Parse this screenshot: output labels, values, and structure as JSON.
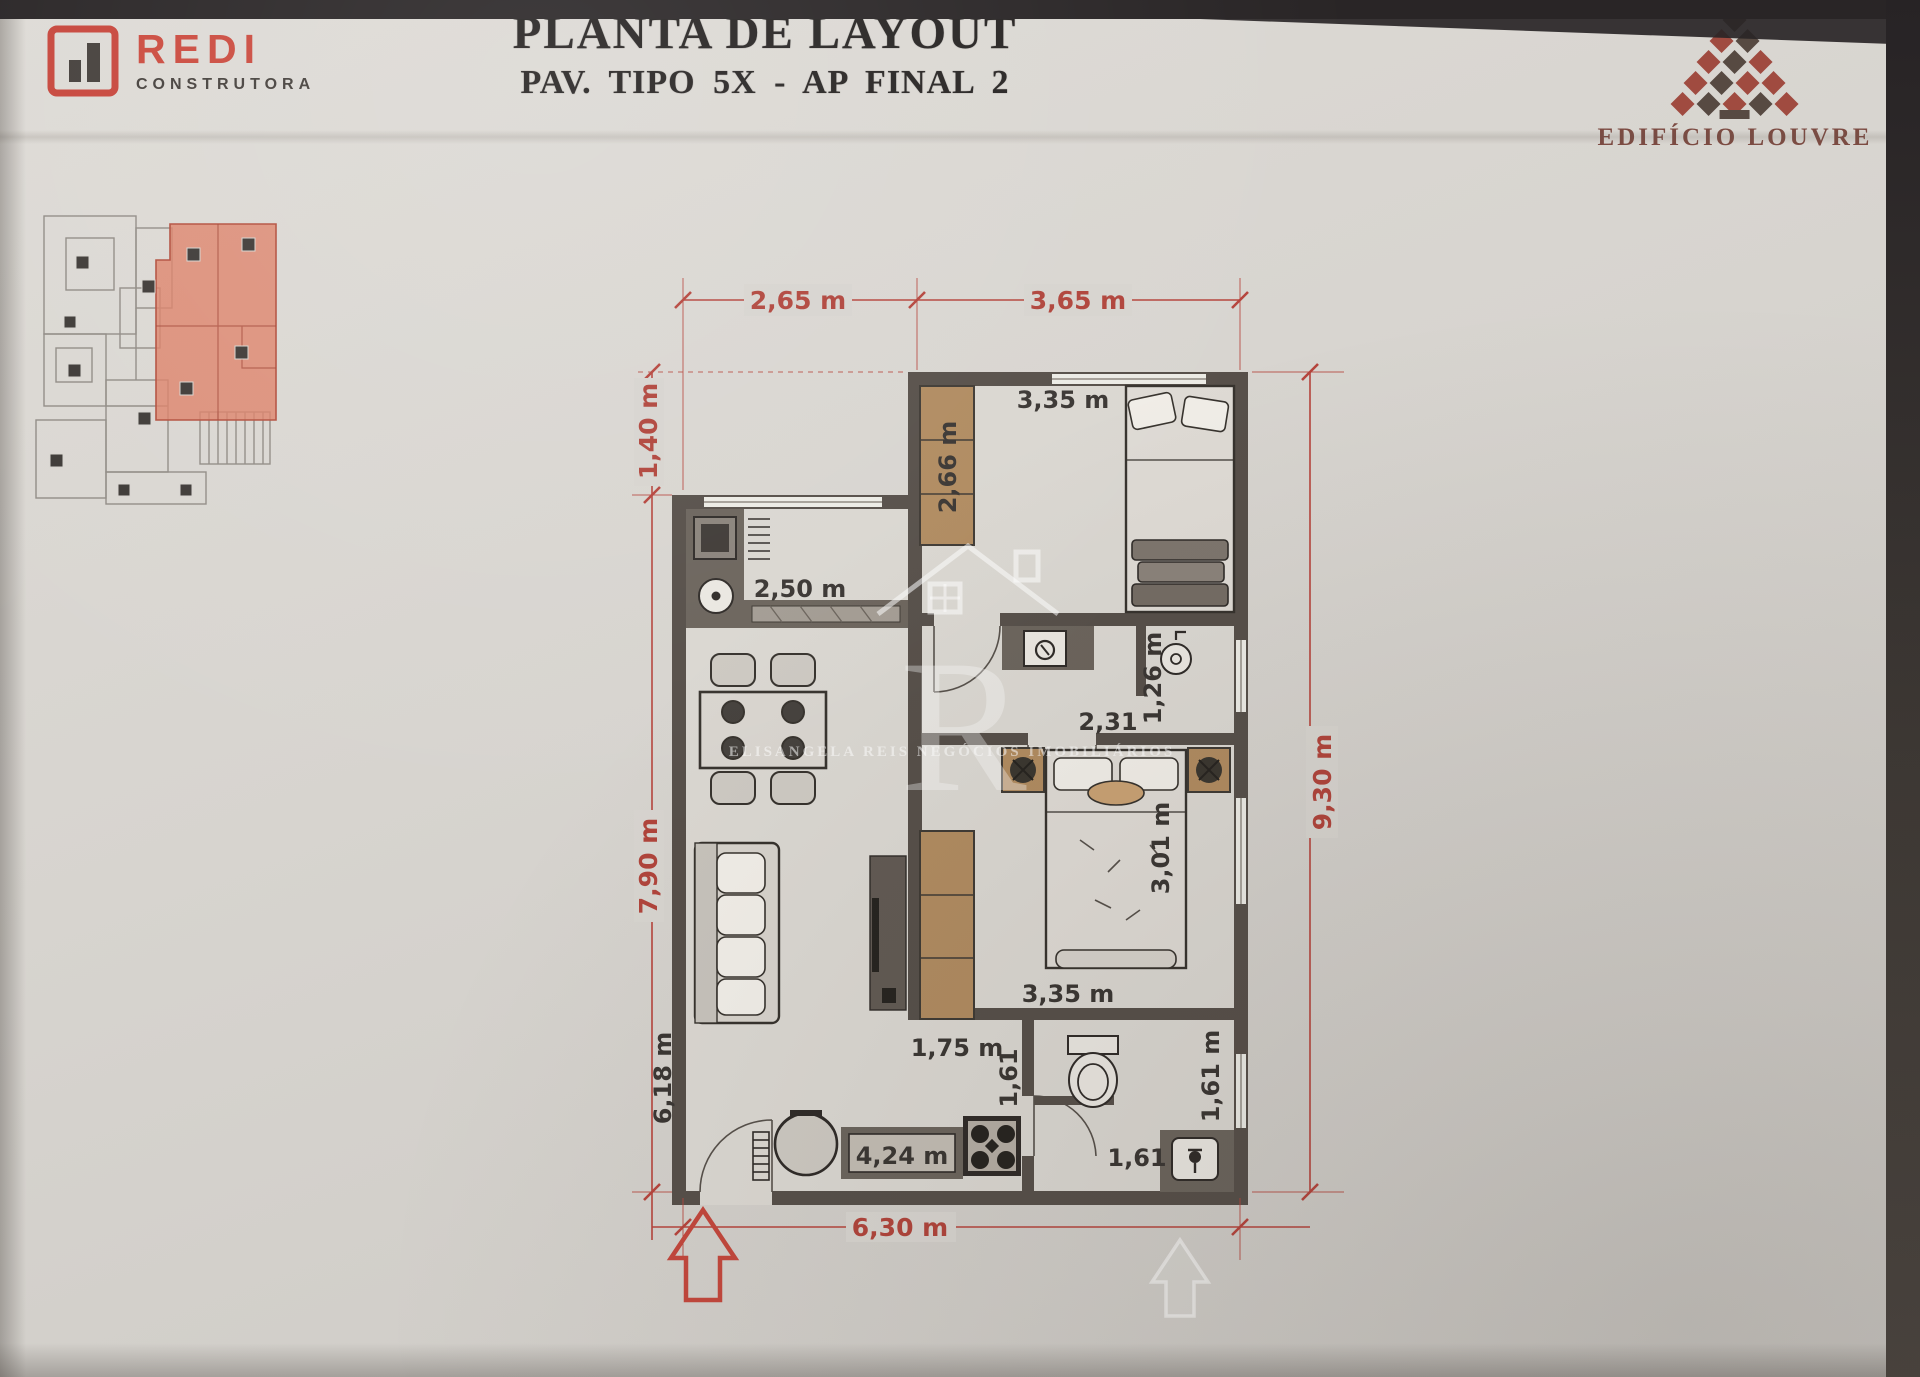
{
  "header": {
    "title": "PLANTA DE LAYOUT",
    "subtitle": "PAV. TIPO 5X - AP FINAL 2"
  },
  "brand_left": {
    "name": "REDI",
    "tagline": "CONSTRUTORA"
  },
  "brand_right": {
    "name": "EDIFÍCIO LOUVRE"
  },
  "watermark": {
    "monogram": "R",
    "caption": "ELISANGELA REIS NEGÓCIOS IMOBILIÁRIOS"
  },
  "dims": {
    "exterior": {
      "top_left": "2,65 m",
      "top_right": "3,65 m",
      "left_offset": "1,40 m",
      "left_main": "7,90 m",
      "right_total": "9,30 m",
      "bottom_total": "6,30 m"
    },
    "interior": {
      "bedroom1_width": "3,35 m",
      "wardrobe1": "2,66 m",
      "kitchen_width": "2,50 m",
      "hall_width": "2,31",
      "laundry_width": "1,26 m",
      "bedroom2_length": "3,01 m",
      "bedroom2_width": "3,35 m",
      "passage_width": "1,75 m",
      "passage_side": "1,61",
      "living_length": "6,18 m",
      "counter_length": "4,24 m",
      "bathroom_width": "1,61",
      "bathroom_length": "1,61 m"
    }
  },
  "icons": {
    "redi_mark": "bar-chart-in-red-square",
    "louvre_pyramid": "diamond-lattice-pyramid",
    "entrance_arrow": "outlined-up-arrow",
    "washing_machine": "front-load-washer",
    "laundry_tub": "round-tub",
    "plant": "potted-plant"
  },
  "colors": {
    "paper": "#d7d4cf",
    "accent_red": "#cb4a3e",
    "dimension_red": "#b5443c",
    "dimension_black": "#3a3633",
    "wall": "#564f49",
    "wardrobe_wood": "#b08b60",
    "key_plan_highlight": "#dd8168",
    "louvre_maroon": "#7c4b42"
  }
}
